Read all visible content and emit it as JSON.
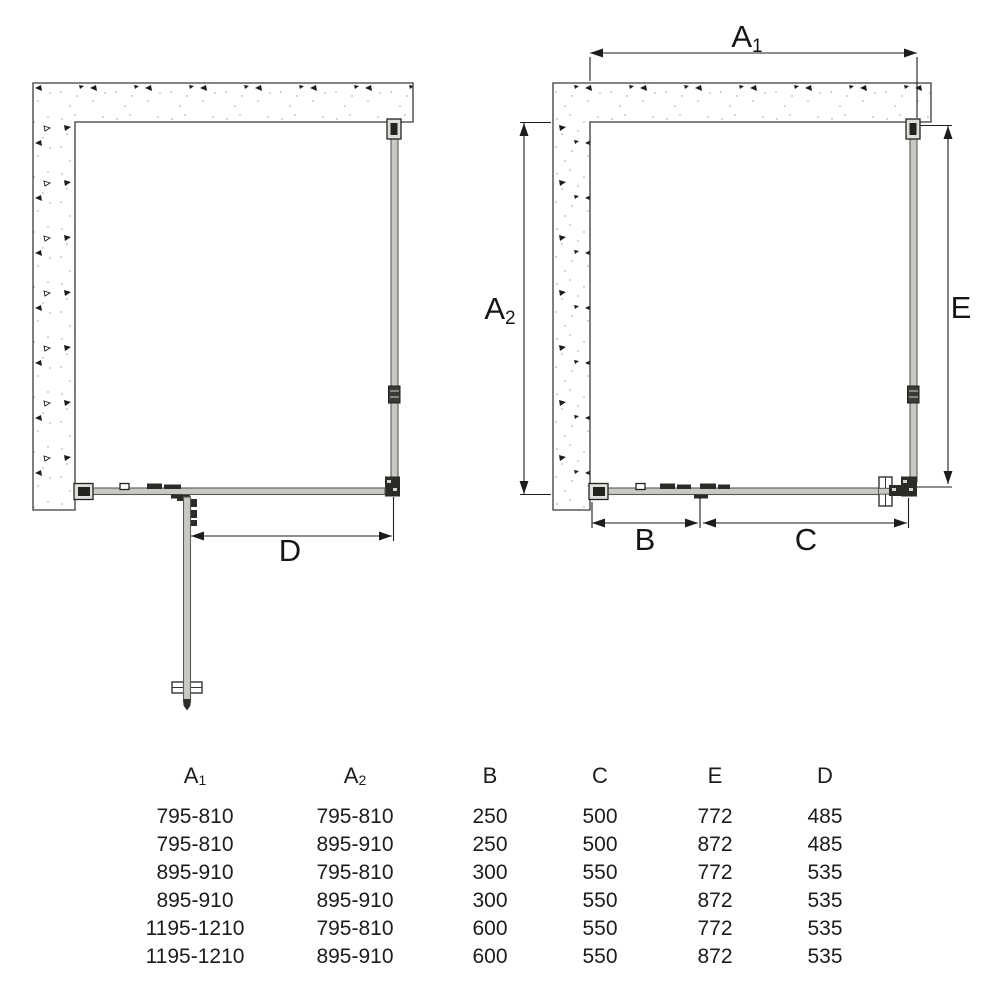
{
  "diagram": {
    "open_door_view": {
      "dim_label_d": "D"
    },
    "closed_view": {
      "dim_labels": {
        "a1": {
          "base": "A",
          "sub": "1"
        },
        "a2": {
          "base": "A",
          "sub": "2"
        },
        "b": "B",
        "c": "C",
        "e": "E"
      }
    },
    "colors": {
      "line": "#1d1d1b",
      "glass_fill": "#c9c9c4",
      "glass_edge": "#5a5a54",
      "hardware": "#2b2b28",
      "wall_outline": "#3a3a38"
    }
  },
  "table": {
    "headers": {
      "a1": {
        "base": "A",
        "sub": "1"
      },
      "a2": {
        "base": "A",
        "sub": "2"
      },
      "b": "B",
      "c": "C",
      "e": "E",
      "d": "D"
    },
    "rows": [
      [
        "795-810",
        "795-810",
        "250",
        "500",
        "772",
        "485"
      ],
      [
        "795-810",
        "895-910",
        "250",
        "500",
        "872",
        "485"
      ],
      [
        "895-910",
        "795-810",
        "300",
        "550",
        "772",
        "535"
      ],
      [
        "895-910",
        "895-910",
        "300",
        "550",
        "872",
        "535"
      ],
      [
        "1195-1210",
        "795-810",
        "600",
        "550",
        "772",
        "535"
      ],
      [
        "1195-1210",
        "895-910",
        "600",
        "550",
        "872",
        "535"
      ]
    ]
  }
}
